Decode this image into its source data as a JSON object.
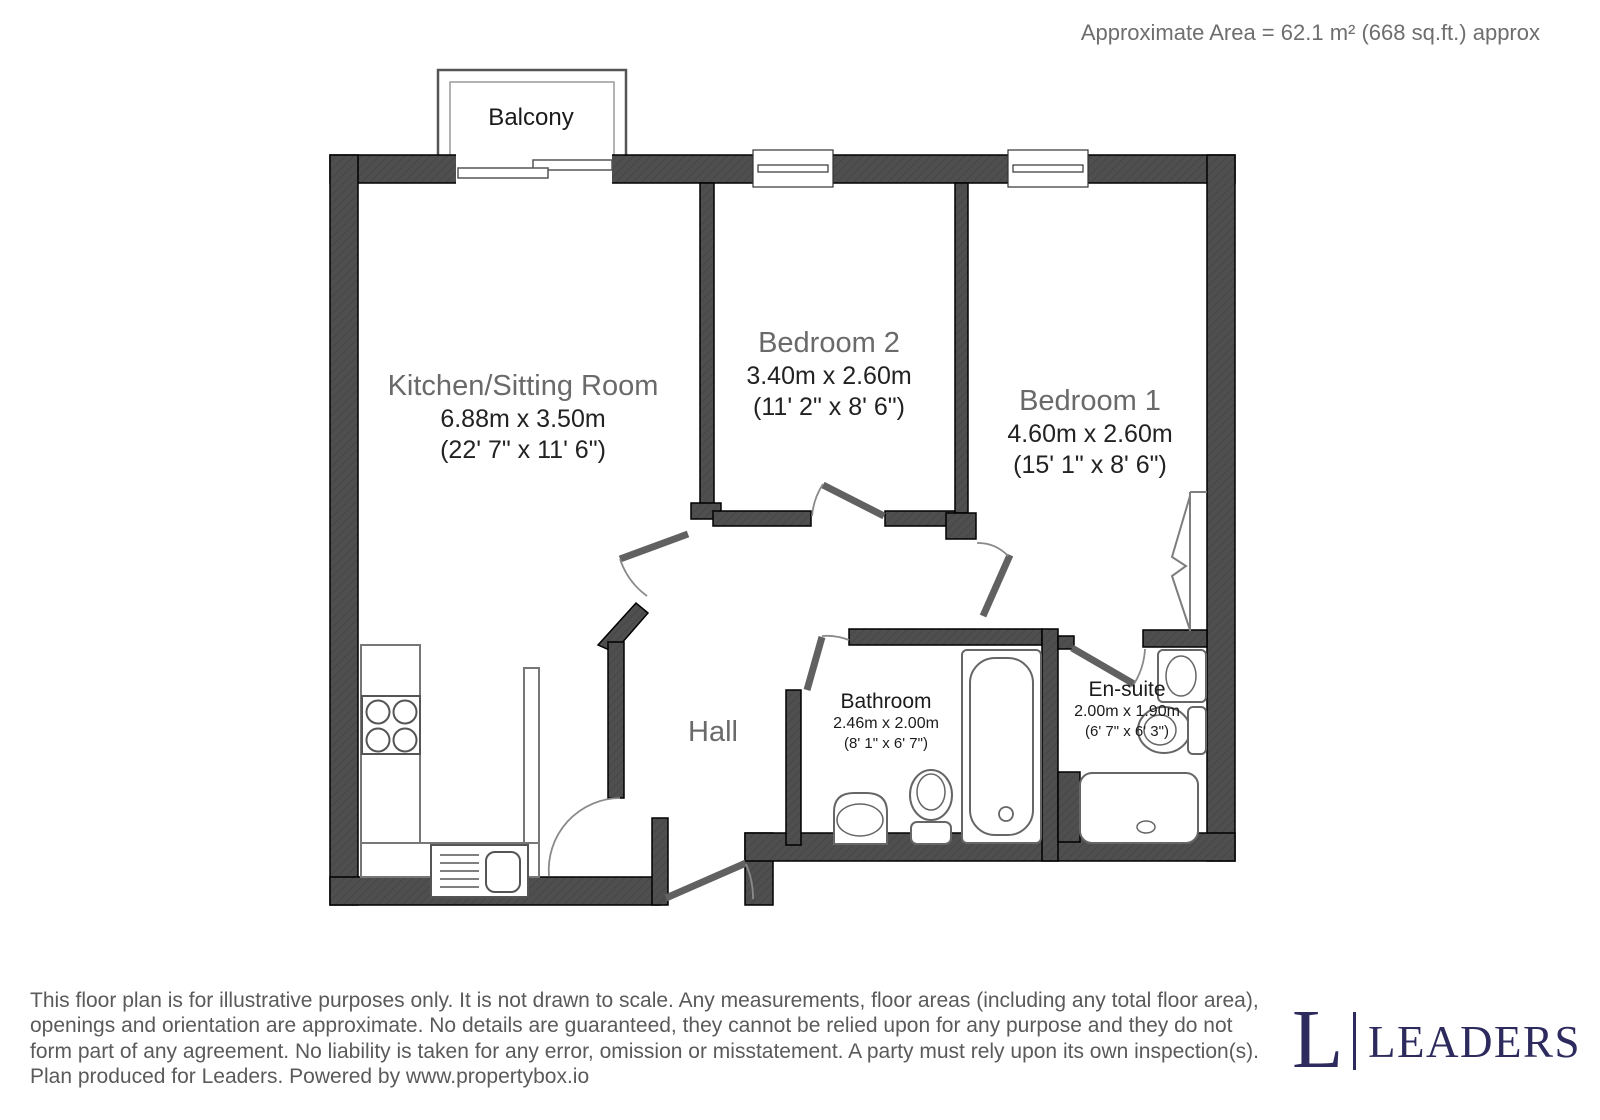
{
  "header": {
    "area_text": "Approximate Area = 62.1 m² (668 sq.ft.) approx"
  },
  "plan": {
    "balcony": {
      "label": "Balcony"
    },
    "hall": {
      "label": "Hall"
    },
    "kitchen": {
      "name": "Kitchen/Sitting Room",
      "metric": "6.88m x 3.50m",
      "imperial": "(22' 7\" x 11' 6\")"
    },
    "bedroom2": {
      "name": "Bedroom 2",
      "metric": "3.40m x 2.60m",
      "imperial": "(11' 2\" x 8' 6\")"
    },
    "bedroom1": {
      "name": "Bedroom 1",
      "metric": "4.60m x 2.60m",
      "imperial": "(15' 1\" x 8' 6\")"
    },
    "bathroom": {
      "name": "Bathroom",
      "metric": "2.46m x 2.00m",
      "imperial": "(8' 1\" x 6' 7\")"
    },
    "ensuite": {
      "name": "En-suite",
      "metric": "2.00m x 1.90m",
      "imperial": "(6' 7\" x 6' 3\")"
    },
    "fixture_icons": [
      "hob-icon",
      "kitchen-sink-icon",
      "bathtub-icon",
      "toilet-icon",
      "wash-basin-icon",
      "shower-tray-icon",
      "wardrobe-icon",
      "sliding-door-icon",
      "window-icon",
      "door-swing-icon"
    ]
  },
  "footer": {
    "disclaimer_lines": [
      "This floor plan is for illustrative purposes only. It is not drawn to scale. Any measurements, floor areas (including any total floor area),",
      "openings and orientation are approximate. No details are guaranteed, they cannot be relied upon for any purpose and they do not",
      "form part of any agreement. No liability is taken for any error, omission or misstatement. A party must rely upon its own inspection(s).",
      "Plan produced for Leaders. Powered by www.propertybox.io"
    ],
    "logo": {
      "initial": "L",
      "wordmark": "LEADERS"
    }
  },
  "colors": {
    "wall": "#4f4f4f",
    "room_name_text": "#6a6a6a",
    "dimension_text": "#222222",
    "muted_text": "#5a5a5a",
    "logo_navy": "#2d2a5e"
  }
}
